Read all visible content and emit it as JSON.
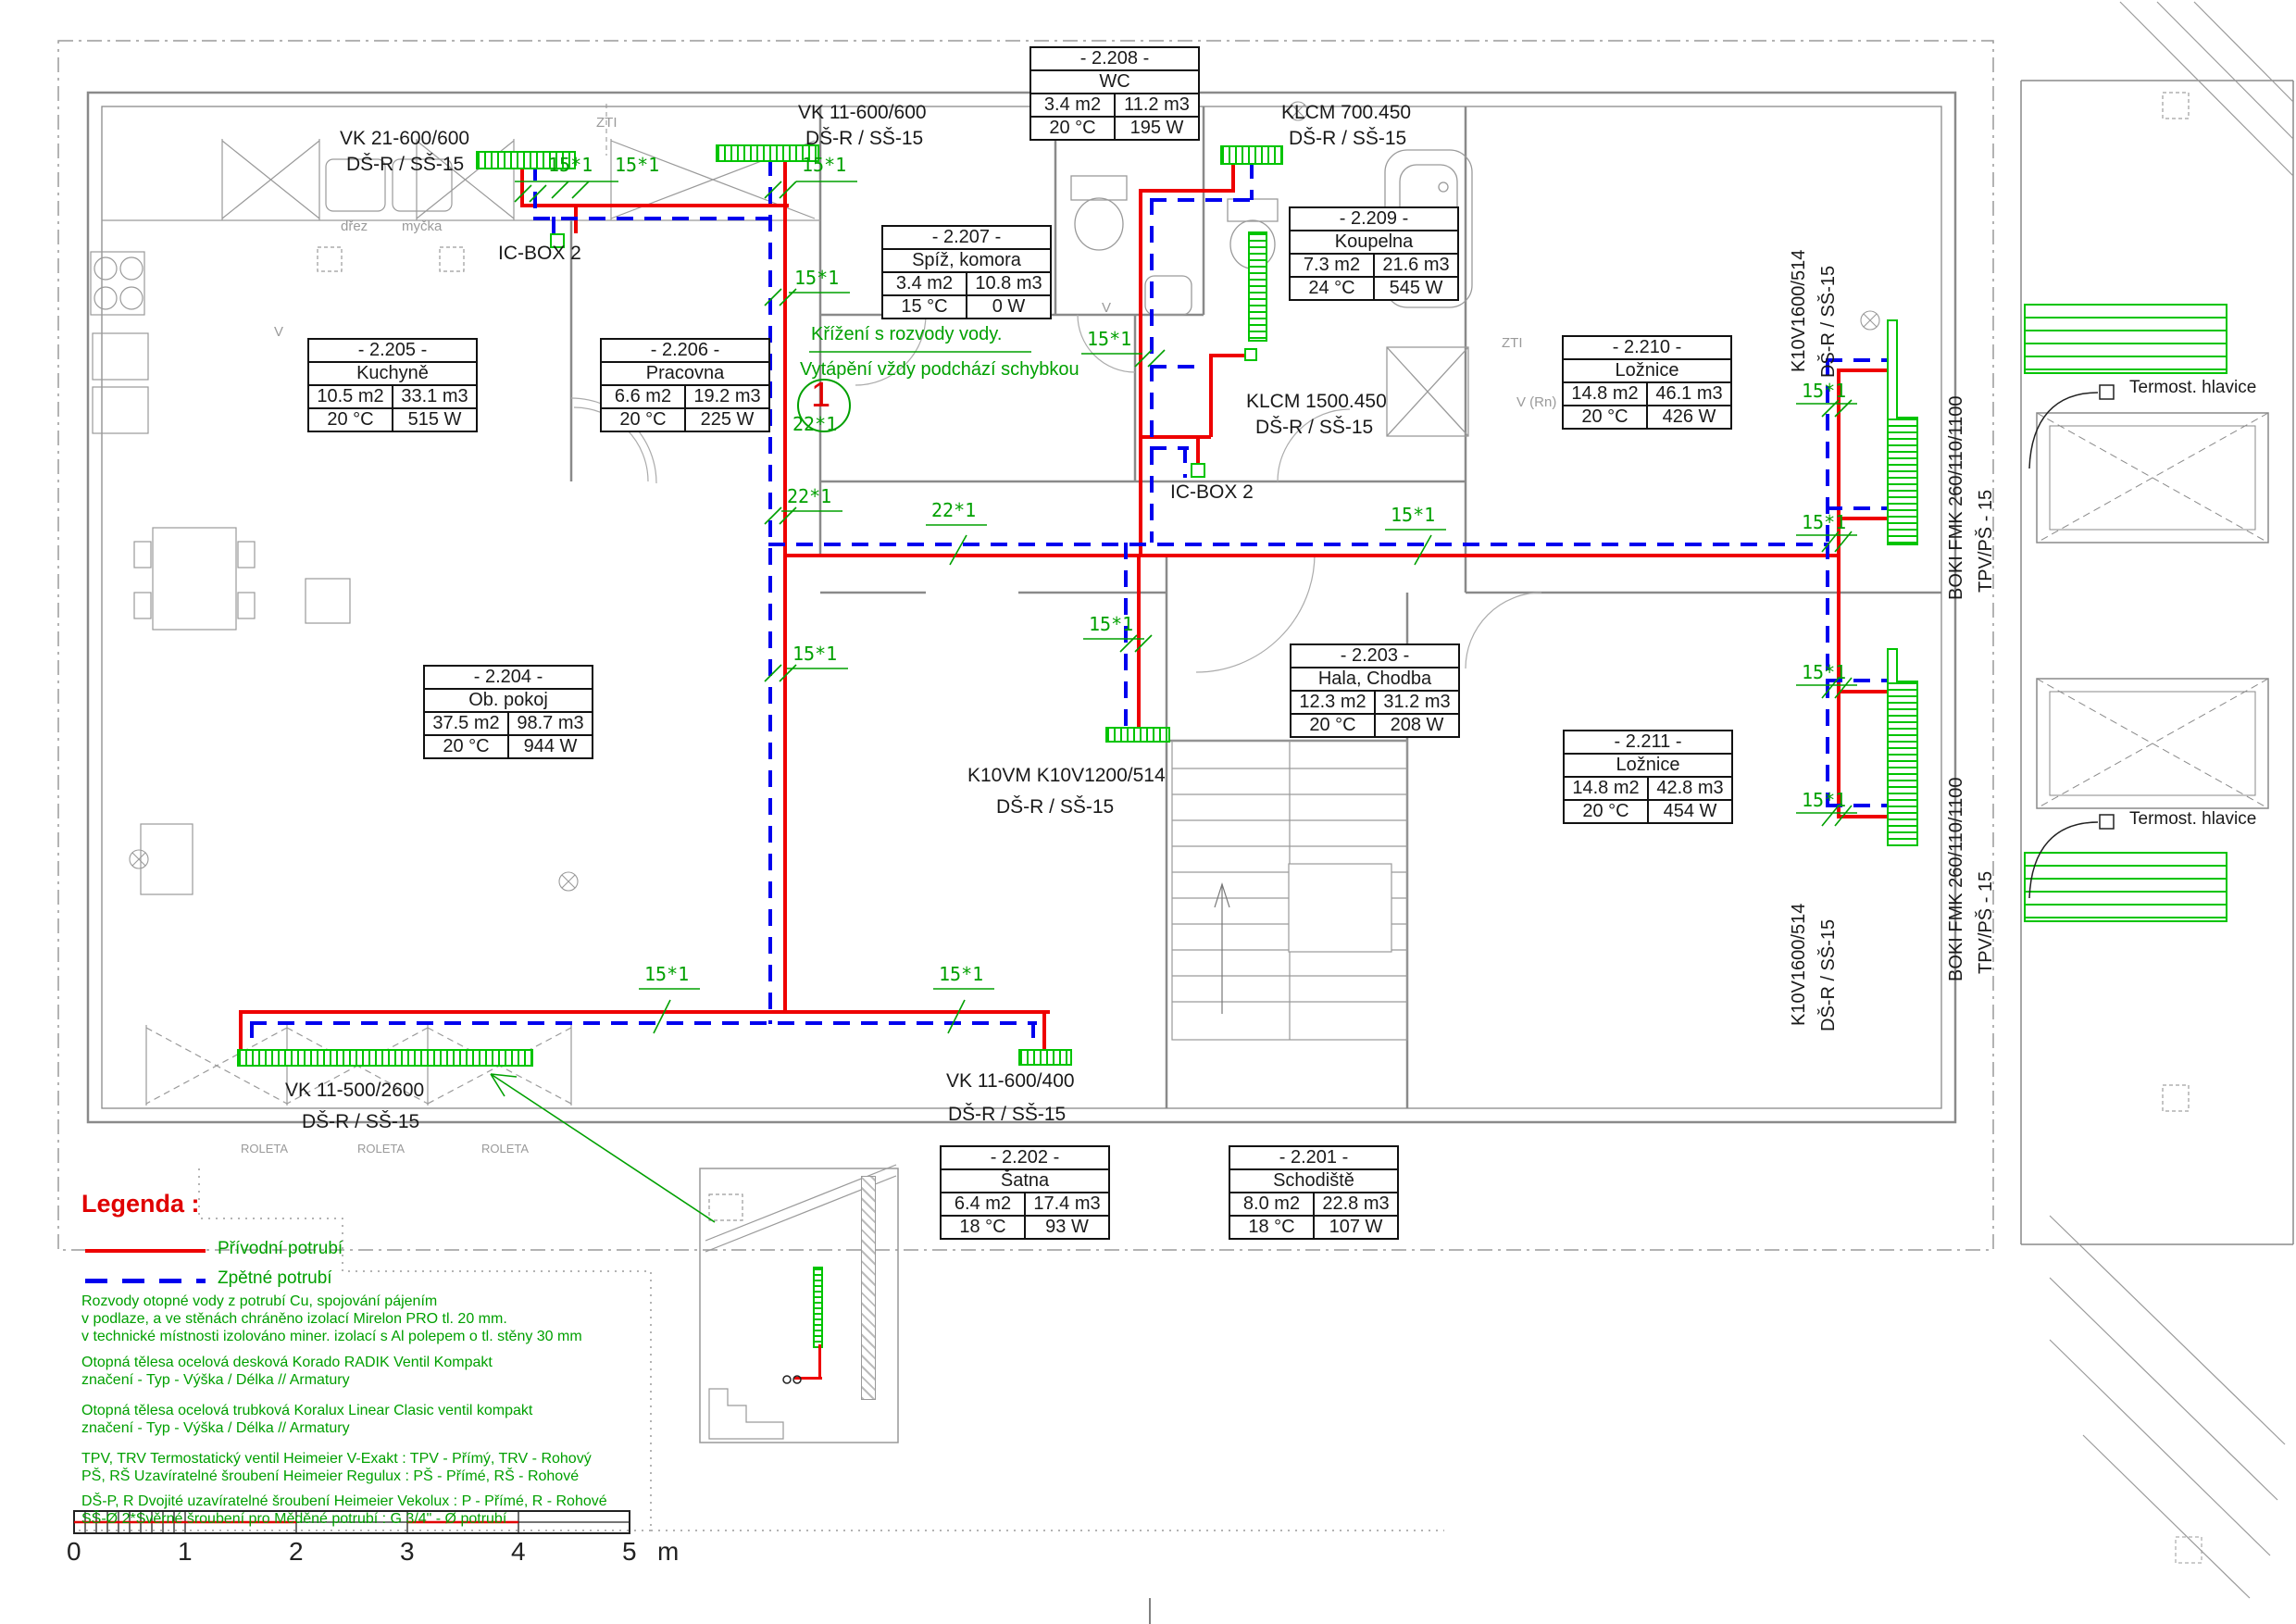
{
  "colors": {
    "supply": "#ee0000",
    "return": "#0000ee",
    "annotation": "#00a000",
    "radiator": "#00c400",
    "walls": "#8a8a8a",
    "text": "#1a1a1a",
    "legend_title": "#e00000"
  },
  "rooms": {
    "r205": {
      "id": "- 2.205 -",
      "name": "Kuchyně",
      "area": "10.5 m2",
      "vol": "33.1 m3",
      "temp": "20 °C",
      "power": "515 W"
    },
    "r206": {
      "id": "- 2.206 -",
      "name": "Pracovna",
      "area": "6.6 m2",
      "vol": "19.2 m3",
      "temp": "20 °C",
      "power": "225 W"
    },
    "r207": {
      "id": "- 2.207 -",
      "name": "Spíž, komora",
      "area": "3.4 m2",
      "vol": "10.8 m3",
      "temp": "15 °C",
      "power": "0 W"
    },
    "r208": {
      "id": "- 2.208 -",
      "name": "WC",
      "area": "3.4 m2",
      "vol": "11.2 m3",
      "temp": "20 °C",
      "power": "195 W"
    },
    "r209": {
      "id": "- 2.209 -",
      "name": "Koupelna",
      "area": "7.3 m2",
      "vol": "21.6 m3",
      "temp": "24 °C",
      "power": "545 W"
    },
    "r210": {
      "id": "- 2.210 -",
      "name": "Ložnice",
      "area": "14.8 m2",
      "vol": "46.1 m3",
      "temp": "20 °C",
      "power": "426 W"
    },
    "r211": {
      "id": "- 2.211 -",
      "name": "Ložnice",
      "area": "14.8 m2",
      "vol": "42.8 m3",
      "temp": "20 °C",
      "power": "454 W"
    },
    "r203": {
      "id": "- 2.203 -",
      "name": "Hala, Chodba",
      "area": "12.3 m2",
      "vol": "31.2 m3",
      "temp": "20 °C",
      "power": "208 W"
    },
    "r204": {
      "id": "- 2.204 -",
      "name": "Ob. pokoj",
      "area": "37.5 m2",
      "vol": "98.7 m3",
      "temp": "20 °C",
      "power": "944 W"
    },
    "r202": {
      "id": "- 2.202 -",
      "name": "Šatna",
      "area": "6.4 m2",
      "vol": "17.4 m3",
      "temp": "18 °C",
      "power": "93 W"
    },
    "r201": {
      "id": "- 2.201 -",
      "name": "Schodiště",
      "area": "8.0 m2",
      "vol": "22.8 m3",
      "temp": "18 °C",
      "power": "107 W"
    }
  },
  "radiator_labels": {
    "vk21": {
      "l1": "VK 21-600/600",
      "l2": "DŠ-R / SŠ-15"
    },
    "vk11a": {
      "l1": "VK 11-600/600",
      "l2": "DŠ-R / SŠ-15"
    },
    "klcm700": {
      "l1": "KLCM 700.450",
      "l2": "DŠ-R / SŠ-15"
    },
    "klcm1500": {
      "l1": "KLCM 1500.450",
      "l2": "DŠ-R / SŠ-15"
    },
    "k10vm": {
      "l1": "K10VM K10V1200/514",
      "l2": "DŠ-R / SŠ-15"
    },
    "vk11b": {
      "l1": "VK 11-500/2600",
      "l2": "DŠ-R / SŠ-15"
    },
    "vk11c": {
      "l1": "VK 11-600/400",
      "l2": "DŠ-R / SŠ-15"
    },
    "k10v_vert": {
      "l1": "K10V1600/514",
      "l2": "DŠ-R / SŠ-15"
    },
    "boki": {
      "l1": "BOKI FMK 260/110/1100",
      "l2": "TPV/PŠ - 15"
    },
    "icbox": "IC-BOX 2",
    "termost": "Termost. hlavice"
  },
  "annotations": {
    "d15": "15*1",
    "d22": "22*1",
    "ref1": "1",
    "note1": "Křížení s rozvody vody.",
    "note2": "Vytápění vždy podchází schybkou"
  },
  "plan_labels": {
    "zti": "ZTI",
    "vrn": "V (Rn)",
    "drez": "dřez",
    "mycka": "myčka",
    "roleta": "ROLETA",
    "v": "V"
  },
  "legend": {
    "title": "Legenda :",
    "supply": "Přívodní potrubí",
    "return": "Zpětné potrubí",
    "notes": [
      "Rozvody otopné vody z potrubí Cu, spojování pájením",
      "v podlaze, a ve stěnách chráněno izolací Mirelon PRO tl. 20 mm.",
      "v technické místnosti izolováno miner. izolací s Al polepem o tl. stěny 30 mm",
      "Otopná tělesa ocelová desková Korado RADIK Ventil Kompakt",
      "značení - Typ - Výška / Délka  // Armatury",
      "Otopná tělesa ocelová trubková Koralux Linear Clasic ventil kompakt",
      "značení - Typ - Výška / Délka  // Armatury",
      "TPV, TRV Termostatický ventil Heimeier V-Exakt : TPV - Přímý, TRV - Rohový",
      "PŠ, RŠ  Uzavíratelné šroubení Heimeier Regulux : PŠ - Přímé, RŠ - Rohové",
      "DŠ-P, R Dvojité uzavíratelné šroubení Heimeier Vekolux : P - Přímé, R - Rohové",
      "SŠ-Ø    2*Svěrné šroubení pro Měděné potrubí : G 3/4\" - Ø potrubí"
    ]
  },
  "scalebar": {
    "ticks": [
      "0",
      "1",
      "2",
      "3",
      "4",
      "5"
    ],
    "unit": "m"
  }
}
